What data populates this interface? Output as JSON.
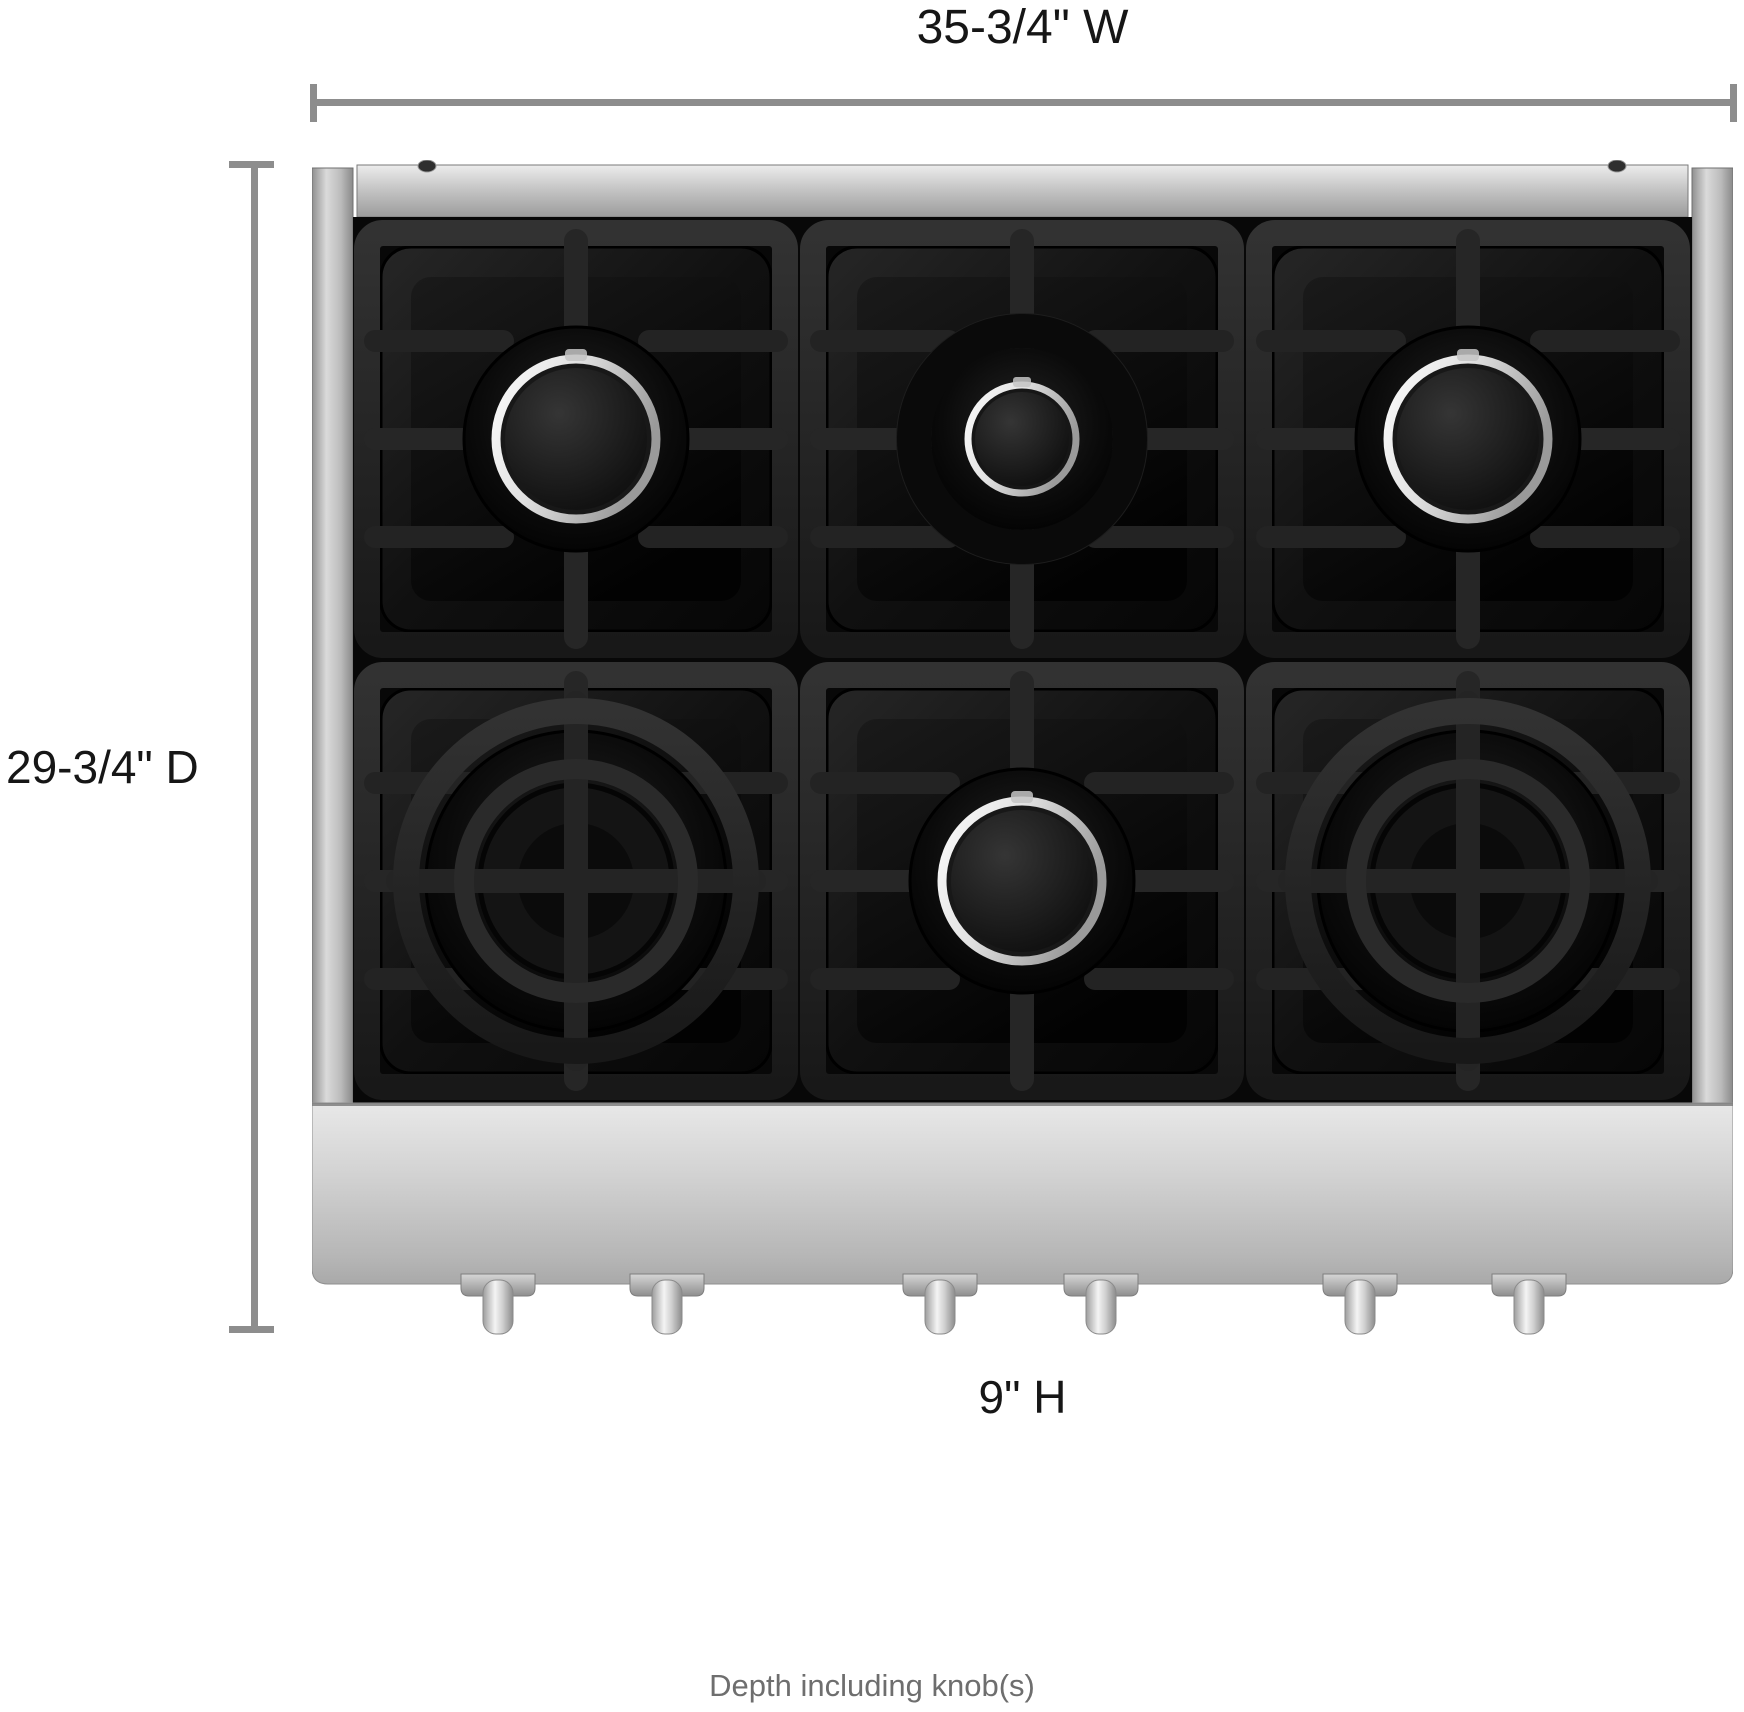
{
  "diagram": {
    "type": "product-dimension-diagram",
    "subject": "6-burner gas rangetop, top view",
    "labels": {
      "width": "35-3/4\" W",
      "depth": "29-3/4\" D",
      "height": "9\" H",
      "footnote": "Depth including knob(s)"
    },
    "colors": {
      "background": "#ffffff",
      "dimension_line": "#8d8d8d",
      "label_text": "#161616",
      "footnote_text": "#6e6e6e",
      "stainless_steel": "#c4c4c4",
      "grate_black": "#1f1f1f",
      "enamel_black": "#0a0a0a",
      "chrome_ring": "#f2f2f2"
    },
    "burners": {
      "rows": 2,
      "cols": 3,
      "items": [
        {
          "row": 1,
          "col": 1,
          "type": "standard",
          "name": "burner-top-left"
        },
        {
          "row": 1,
          "col": 2,
          "type": "simmer",
          "name": "burner-top-center"
        },
        {
          "row": 1,
          "col": 3,
          "type": "standard",
          "name": "burner-top-right"
        },
        {
          "row": 2,
          "col": 1,
          "type": "dual",
          "name": "burner-bottom-left"
        },
        {
          "row": 2,
          "col": 2,
          "type": "standard",
          "name": "burner-bottom-center"
        },
        {
          "row": 2,
          "col": 3,
          "type": "dual",
          "name": "burner-bottom-right"
        }
      ]
    },
    "knobs": {
      "count": 6,
      "x_positions": [
        186,
        355,
        628,
        789,
        1048,
        1217
      ]
    },
    "screws": {
      "count": 2,
      "x_positions": [
        115,
        1305
      ]
    }
  }
}
